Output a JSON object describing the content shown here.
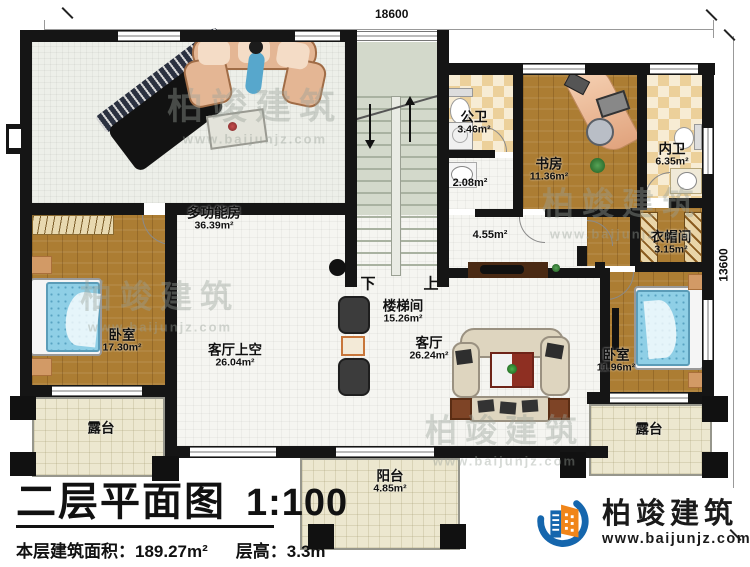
{
  "annotations": {
    "dim_top": "18600",
    "dim_right": "13600"
  },
  "stair": {
    "label_down": "下",
    "label_up": "上"
  },
  "rooms": {
    "multifunction": {
      "name": "多功能房",
      "area": "36.39m²"
    },
    "stair_hall": {
      "name": "楼梯间",
      "area": "15.26m²"
    },
    "public_bath": {
      "name": "公卫",
      "area": "3.46m²"
    },
    "basin_area": {
      "area": "2.08m²"
    },
    "study": {
      "name": "书房",
      "area": "11.36m²"
    },
    "ensuite_bath": {
      "name": "内卫",
      "area": "6.35m²"
    },
    "cloakroom": {
      "name": "衣帽间",
      "area": "3.15m²"
    },
    "hallway": {
      "area": "4.55m²"
    },
    "bedroom_left": {
      "name": "卧室",
      "area": "17.30m²"
    },
    "living_void": {
      "name": "客厅上空",
      "area": "26.04m²"
    },
    "living": {
      "name": "客厅",
      "area": "26.24m²"
    },
    "bedroom_right": {
      "name": "卧室",
      "area": "11.96m²"
    },
    "terrace_left": {
      "name": "露台"
    },
    "terrace_right": {
      "name": "露台"
    },
    "balcony": {
      "name": "阳台",
      "area": "4.85m²"
    }
  },
  "title_block": {
    "title": "二层平面图",
    "scale": "1:100",
    "area_label": "本层建筑面积：",
    "area_value": "189.27m²",
    "floor_height_label": "层高：",
    "floor_height_value": "3.3m"
  },
  "brand": {
    "name": "柏竣建筑",
    "url": "www.baijunjz.com"
  },
  "watermark": {
    "name": "柏竣建筑",
    "url": "www.baijunjz.com"
  },
  "colors": {
    "wall": "#151515",
    "wood_floor": "#ac7d33",
    "tile_light": "#f7ecd4",
    "tile_dark": "#ecd09a",
    "stair_floor": "#d3d9cb",
    "terrace_floor": "#ece7cf",
    "brand_blue": "#1566ad",
    "brand_orange": "#f08519"
  }
}
